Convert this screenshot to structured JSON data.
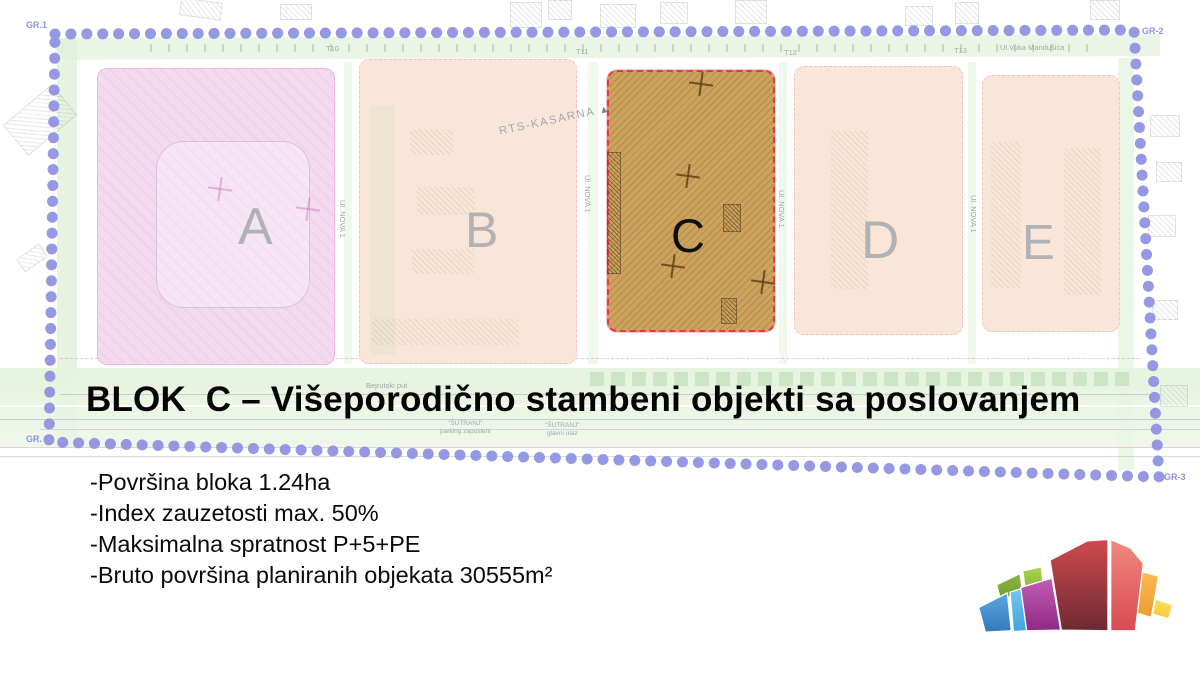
{
  "title": "BLOK  C – Višeporodično stambeni objekti sa poslovanjem",
  "details": {
    "lines": [
      "-Površina bloka 1.24ha",
      "-Index zauzetosti max. 50%",
      "-Maksimalna spratnost P+5+PE",
      "-Bruto površina planiranih objekata 30555m²"
    ]
  },
  "map": {
    "blocks": {
      "a": {
        "label": "A"
      },
      "b": {
        "label": "B",
        "annotation": "RTS-KASARNA",
        "annotation_marker": "▲"
      },
      "c": {
        "label": "C"
      },
      "d": {
        "label": "D"
      },
      "e": {
        "label": "E"
      }
    },
    "boundary": {
      "top_left": "GR.1",
      "top_right": "GR-2",
      "bottom_right": "GR-3",
      "bottom_left": "GR."
    },
    "streets": {
      "top": "Ul.Vuka Mandušića",
      "vertical": "Ul. NOVA 1",
      "bottom_left": "Bejrutski put",
      "sutranj_parking": "\"ŠUTRANJ\"\nparking zaposleni",
      "sutranj_entrance": "\"ŠUTRANJ\"\nglavni ulaz",
      "markers": {
        "t10": "T10",
        "t11": "T11",
        "t12": "T12",
        "t13": "T13"
      }
    },
    "colors": {
      "boundary_dots": "#8f92e0",
      "block_a_fill": "#f2d7ee",
      "block_bde_fill": "#fae5d7",
      "block_c_fill": "#cda25d",
      "block_c_border": "#e8344f",
      "letter_gray": "#b0b2b5",
      "letter_c": "#101010"
    }
  },
  "logo": {
    "name": "colorful-fan-city-logo",
    "colors": {
      "blue": "#4a9ad9",
      "light_blue": "#5fc0ec",
      "green_dark": "#7fae3a",
      "green_light": "#a2cc49",
      "magenta": "#b4479f",
      "dark_red": "#8c3038",
      "red": "#e4595b",
      "orange": "#f2a43c",
      "yellow": "#fcd34b"
    }
  }
}
